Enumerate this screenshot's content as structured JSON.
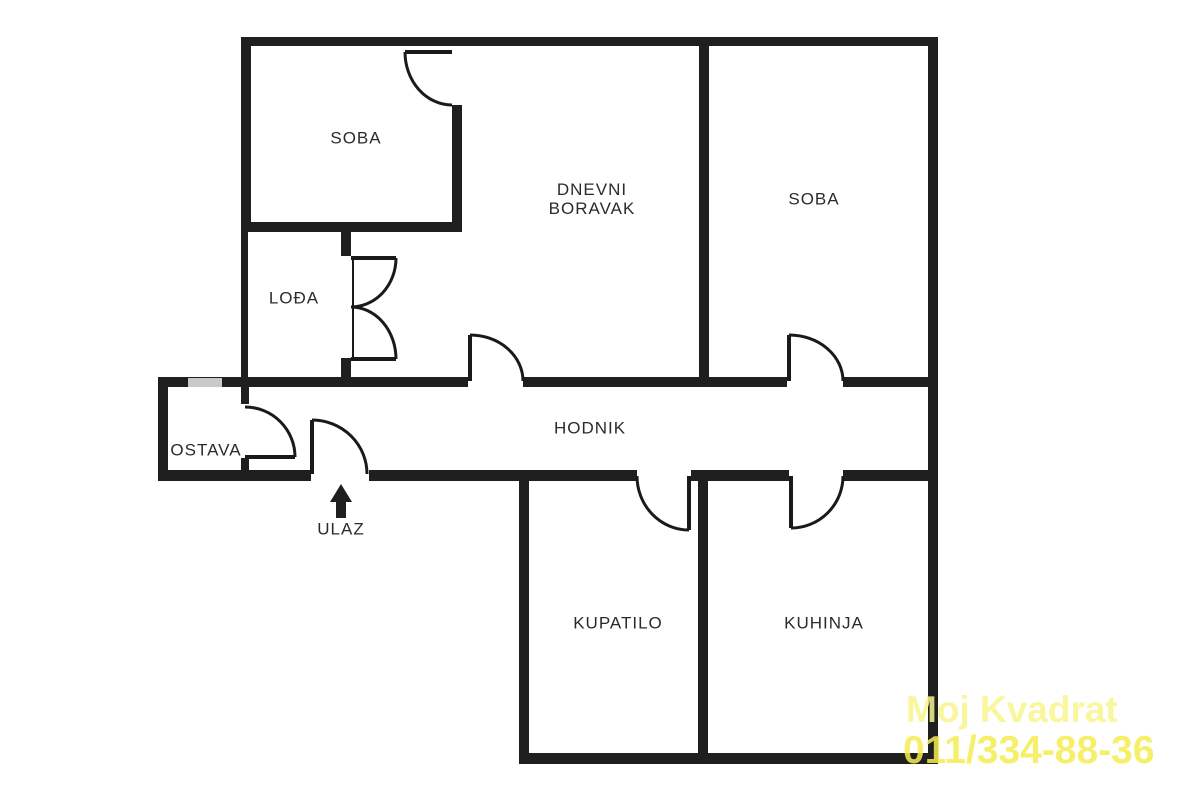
{
  "plan": {
    "type": "apartment-floor-plan",
    "rooms": [
      {
        "id": "soba-top-left",
        "label": "SOBA"
      },
      {
        "id": "dnevni-boravak",
        "label": "DNEVNI BORAVAK"
      },
      {
        "id": "soba-right",
        "label": "SOBA"
      },
      {
        "id": "lodja",
        "label": "LOĐA"
      },
      {
        "id": "ostava",
        "label": "OSTAVA"
      },
      {
        "id": "hodnik",
        "label": "HODNIK"
      },
      {
        "id": "kupatilo",
        "label": "KUPATILO"
      },
      {
        "id": "kuhinja",
        "label": "KUHINJA"
      }
    ],
    "entrance_label": "ULAZ"
  },
  "watermark": {
    "line1": "Moj Kvadrat",
    "line2": "011/334-88-36"
  },
  "colors": {
    "wall": "#1f1f1f",
    "door": "#1a1a1a",
    "text": "#2b2b2b",
    "window_marker": "#c9c9c9",
    "background": "#ffffff",
    "watermark_line1": "#f8f58c",
    "watermark_line2": "#f4ed50"
  }
}
